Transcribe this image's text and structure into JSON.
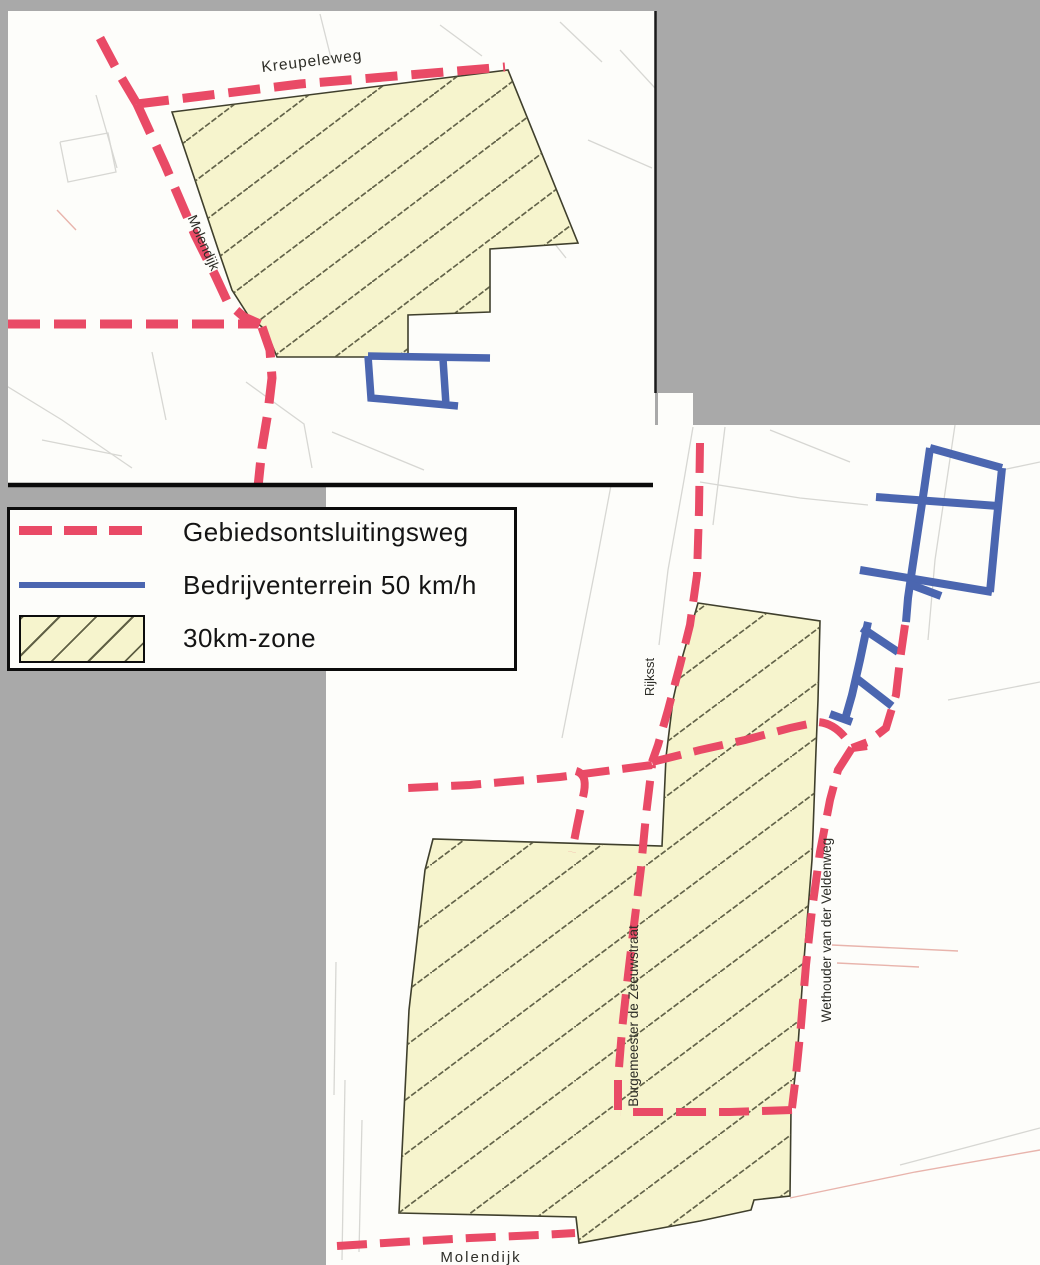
{
  "colors": {
    "background": "#a9a9a9",
    "panel_white": "#fdfdfa",
    "road_red": "#e94a66",
    "business_blue": "#4b66b0",
    "zone_fill": "#f6f4cd",
    "hatch_line": "#53533a",
    "border_black": "#0c0c0c"
  },
  "legend": {
    "items": [
      {
        "swatch": "red-dashed-line",
        "label": "Gebiedsontsluitingsweg"
      },
      {
        "swatch": "blue-solid-line",
        "label": "Bedrijventerrein 50 km/h"
      },
      {
        "swatch": "yellow-hatched-area",
        "label": "30km-zone"
      }
    ]
  },
  "top_map": {
    "labels": {
      "kreupeleweg": "Kreupeleweg",
      "molendijk": "Molendijk"
    }
  },
  "bottom_map": {
    "labels": {
      "rijksstraat": "Rijksst",
      "burgemeester": "Burgemeester de Zeeuwstraat",
      "wethouder": "Wethouder van der Veldenweg",
      "molendijk": "Molendijk"
    }
  }
}
